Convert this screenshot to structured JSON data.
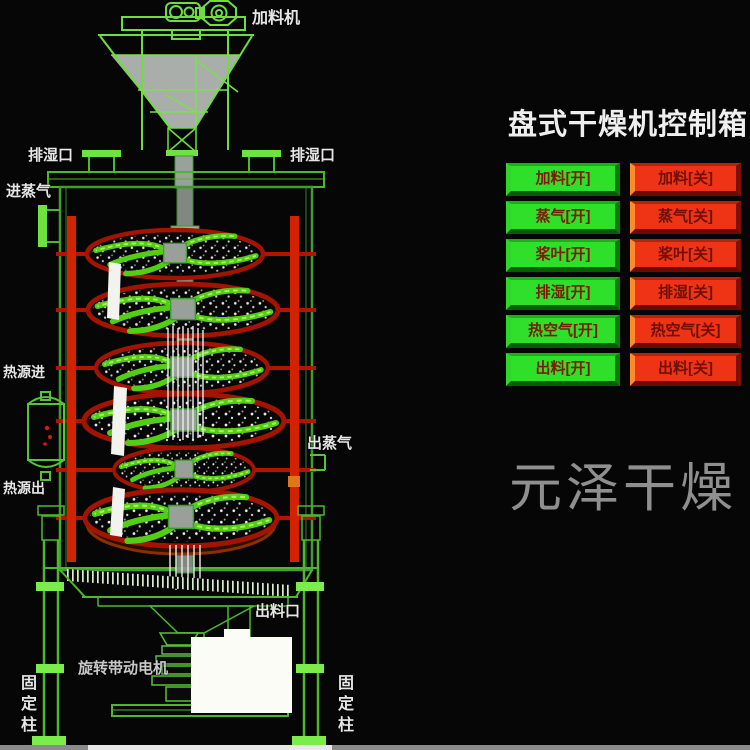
{
  "panel": {
    "title": "盘式干燥机控制箱",
    "rows": [
      {
        "on": "加料[开]",
        "off": "加料[关]"
      },
      {
        "on": "蒸气[开]",
        "off": "蒸气[关]"
      },
      {
        "on": "桨叶[开]",
        "off": "桨叶[关]"
      },
      {
        "on": "排湿[开]",
        "off": "排湿[关]"
      },
      {
        "on": "热空气[开]",
        "off": "热空气[关]"
      },
      {
        "on": "出料[开]",
        "off": "出料[关]"
      }
    ],
    "colors": {
      "on_button": "#2ee02a",
      "off_button": "#ee3414"
    }
  },
  "diagram": {
    "labels": {
      "feeder": "加料机",
      "vent_left": "排湿口",
      "vent_right": "排湿口",
      "steam_in": "进蒸气",
      "heat_in": "热源进",
      "heat_out": "热源出",
      "steam_out": "出蒸气",
      "outlet": "出料口",
      "motor": "旋转带动电机",
      "column_left": "固定柱",
      "column_right": "固定柱"
    },
    "colors": {
      "line_green": "#4db82c",
      "pipe_red": "#d42100",
      "tray_rim_red": "#a31400"
    }
  },
  "watermark": "元泽干燥"
}
